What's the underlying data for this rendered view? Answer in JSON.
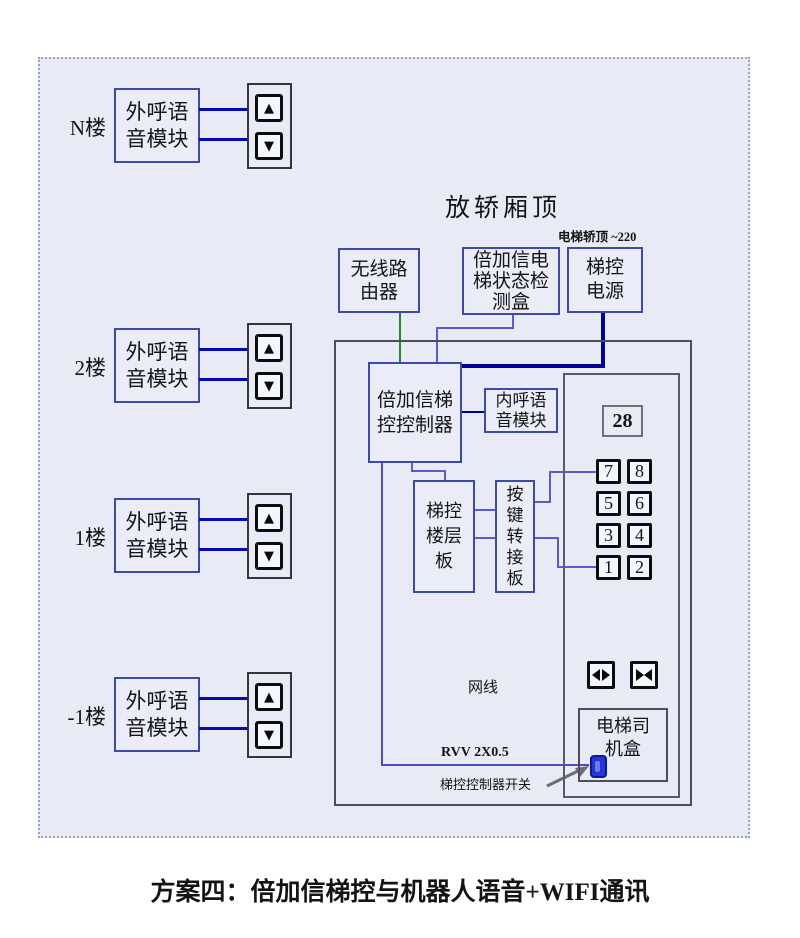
{
  "diagram": {
    "title": "放轿厢顶",
    "power_note": "电梯轿顶 ~220",
    "caption": "方案四：倍加信梯控与机器人语音+WIFI通讯",
    "floors": [
      {
        "label": "N楼",
        "module": "外呼语\n音模块"
      },
      {
        "label": "2楼",
        "module": "外呼语\n音模块"
      },
      {
        "label": "1楼",
        "module": "外呼语\n音模块"
      },
      {
        "label": "-1楼",
        "module": "外呼语\n音模块"
      }
    ],
    "boxes": {
      "router": "无线路\n由器",
      "detector": "倍加信电\n梯状态检\n测盒",
      "power": "梯控\n电源",
      "controller": "倍加信梯\n控控制器",
      "car_voice": "内呼语\n音模块",
      "floor_board": "梯控\n楼层\n板",
      "key_adapter": "按\n键\n转\n接\n板",
      "driver_box": "电梯司\n机盒"
    },
    "panel": {
      "display": "28",
      "buttons": [
        [
          "7",
          "8"
        ],
        [
          "5",
          "6"
        ],
        [
          "3",
          "4"
        ],
        [
          "1",
          "2"
        ]
      ]
    },
    "labels": {
      "network": "网线",
      "cable": "RVV 2X0.5",
      "switch": "梯控控制器开关"
    },
    "icons": {
      "up": "▲",
      "down": "▼"
    },
    "colors": {
      "diagram-bg": "#e8ebf6",
      "box-bg": "#eaedf8",
      "dash": "#98a2c6",
      "blue-border": "#3d49ae",
      "gray-border": "#4e4e5a",
      "panel-border": "#35353f",
      "btn-border": "#0d0d0d",
      "btn-bg": "#f3f6fc",
      "wire-blue": "#0808bb",
      "wire-green": "#1f8a26",
      "wire-lavender": "#5a5ad2",
      "wire-power": "#000096",
      "wire-rvv": "#4d4dc8",
      "switch-blue": "#2336d6",
      "switch-dark": "#0b17a0",
      "arrow-gray": "#6d6d72"
    }
  }
}
